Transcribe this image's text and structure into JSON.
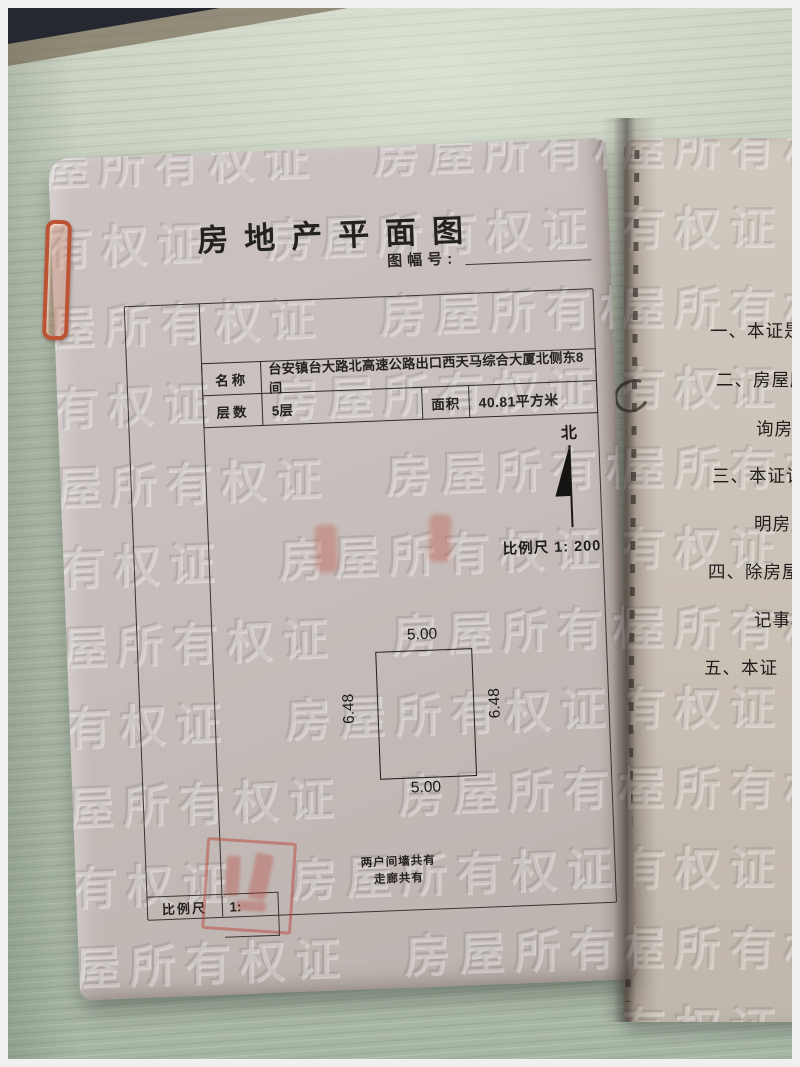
{
  "photo": {
    "watermark_text": "房屋所有权证"
  },
  "left_page": {
    "title": "房地产平面图",
    "sheet_label": "图幅号:",
    "info": {
      "name_label": "名称",
      "name_value": "台安镇台大路北高速公路出口西天马综合大厦北侧东8间",
      "floor_label": "层数",
      "floor_value": "5层",
      "area_label": "面积",
      "area_value": "40.81平方米"
    },
    "north_label": "北",
    "scale_text": "比例尺 1: 200",
    "plan": {
      "top": "5.00",
      "bottom": "5.00",
      "left": "6.48",
      "right": "6.48"
    },
    "share_note": [
      "两户间墙共有",
      "走廊共有"
    ],
    "bottom_scale": {
      "label": "比例尺",
      "value": "1:"
    }
  },
  "right_page": {
    "notes": [
      "一、本证是",
      "二、房屋所",
      "询房屋",
      "三、本证记",
      "明房屋",
      "四、除房屋",
      "记事项",
      "五、本证"
    ]
  },
  "colors": {
    "desk_green": "#b5c1b0",
    "page_pink": "#c7bebb",
    "page_tan": "#c9c0b6",
    "print_black": "#2b2927",
    "stamp_red": "#b72f24",
    "clip_orange": "#bc5334"
  }
}
